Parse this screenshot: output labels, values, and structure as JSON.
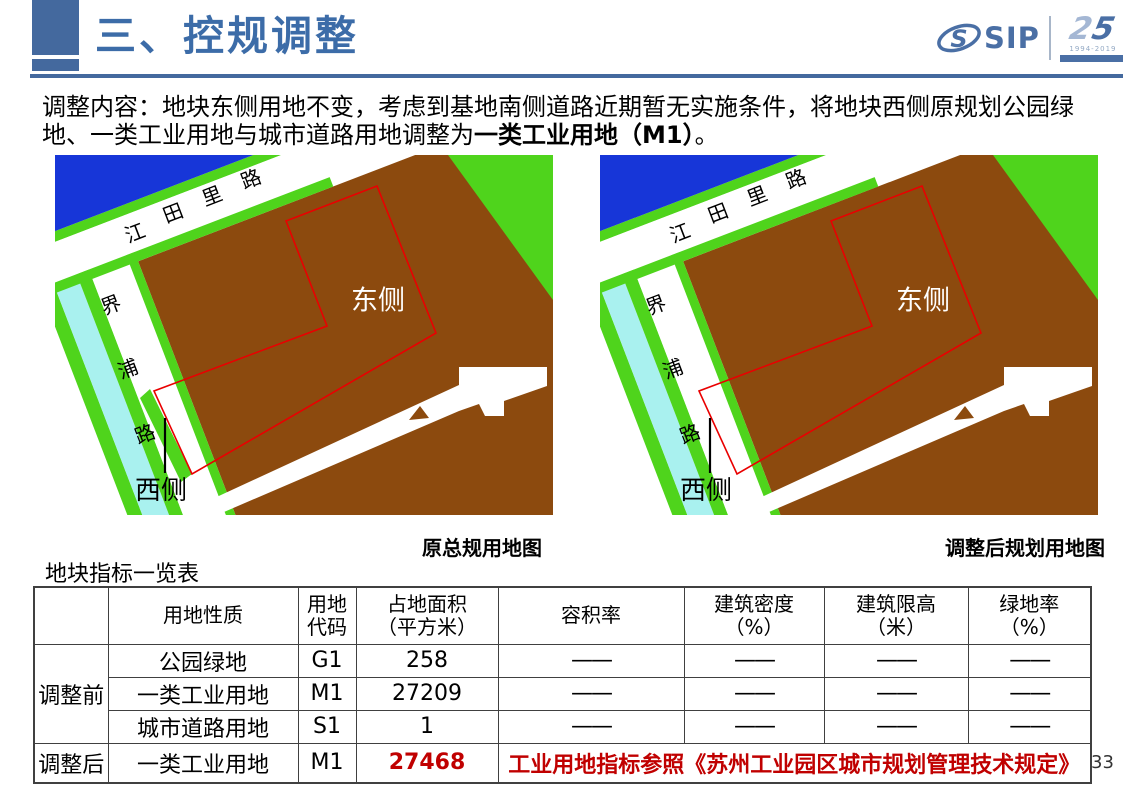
{
  "header": {
    "title": "三、控规调整",
    "logo": {
      "icon_letter": "S",
      "name": "SIP",
      "anniversary_first": "2",
      "anniversary_second": "5",
      "years": "1994-2019"
    }
  },
  "intro": {
    "line1": "调整内容：地块东侧用地不变，考虑到基地南侧道路近期暂无实施条件，将地块西侧原规划公园绿",
    "line2_pre": "地、一类工业用地与城市道路用地调整为",
    "line2_bold": "一类工业用地（M1）",
    "line2_end": "。"
  },
  "maps": {
    "left": {
      "caption": "原总规用地图"
    },
    "right": {
      "caption": "调整后规划用地图"
    },
    "labels": {
      "road_horizontal": "江田里路",
      "road_vertical": "界浦路",
      "east": "东侧",
      "west": "西侧"
    },
    "palette": {
      "water": "#1736d8",
      "green": "#4fd41c",
      "canal": "#a9f1ef",
      "industrial": "#8c4a0e",
      "road": "#ffffff",
      "boundary": "#e90000"
    }
  },
  "table": {
    "title": "地块指标一览表",
    "headers": [
      "",
      "用地性质",
      "用地\n代码",
      "占地面积\n（平方米）",
      "容积率",
      "建筑密度\n（%）",
      "建筑限高\n（米）",
      "绿地率\n（%）"
    ],
    "rows": [
      {
        "group": "调整前",
        "cells": [
          "公园绿地",
          "G1",
          "258",
          "——",
          "——",
          "——",
          "——"
        ]
      },
      {
        "cells": [
          "一类工业用地",
          "M1",
          "27209",
          "——",
          "——",
          "——",
          "——"
        ]
      },
      {
        "cells": [
          "城市道路用地",
          "S1",
          "1",
          "——",
          "——",
          "——",
          "——"
        ]
      },
      {
        "group": "调整后",
        "cells": [
          "一类工业用地",
          "M1",
          "27468"
        ],
        "note": "工业用地指标参照《苏州工业园区城市规划管理技术规定》"
      }
    ]
  },
  "page_number": "33",
  "colors": {
    "accent": "#44699e",
    "title_blue": "#3c6ca8",
    "logo_blue": "#4a6fa5",
    "table_red": "#c00000"
  }
}
